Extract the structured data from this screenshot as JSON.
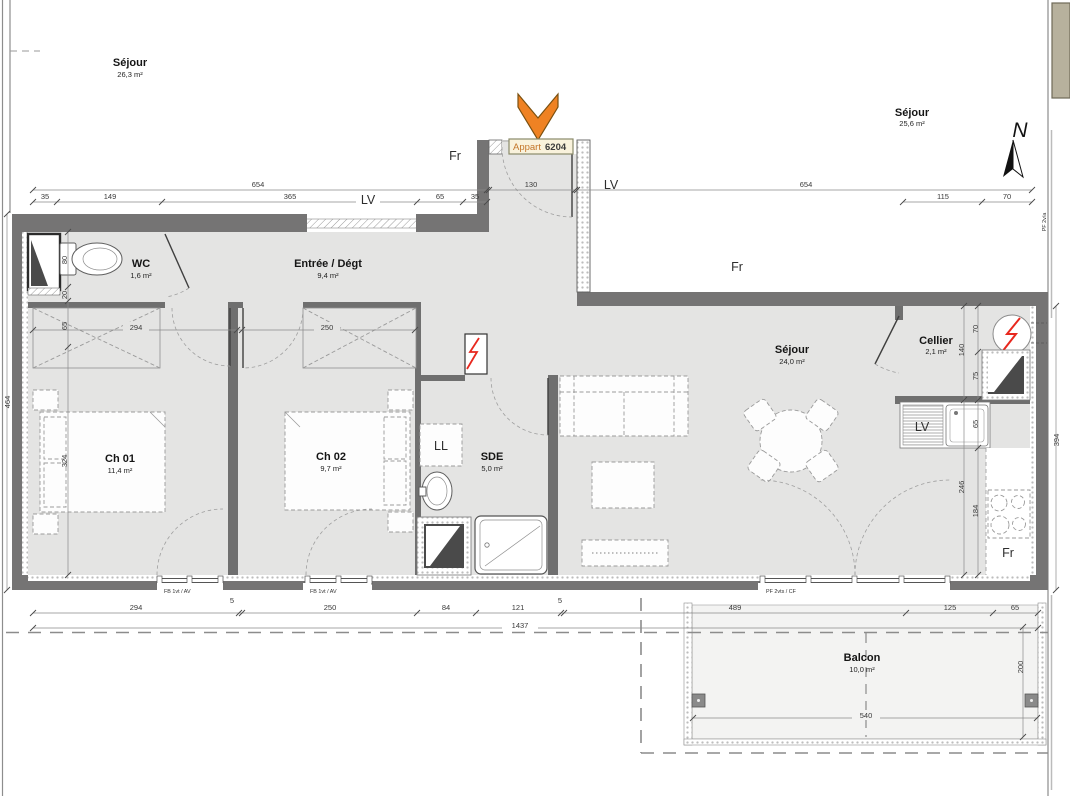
{
  "plan": {
    "apartment": {
      "prefix": "Appart",
      "number": "6204"
    },
    "north_label": "N",
    "rooms": {
      "neighbor_left": {
        "name": "Séjour",
        "area": "26,3 m²"
      },
      "neighbor_right": {
        "name": "Séjour",
        "area": "25,6 m²"
      },
      "wc": {
        "name": "WC",
        "area": "1,6 m²"
      },
      "entree": {
        "name": "Entrée / Dégt",
        "area": "9,4 m²"
      },
      "ch01": {
        "name": "Ch 01",
        "area": "11,4 m²"
      },
      "ch02": {
        "name": "Ch 02",
        "area": "9,7 m²"
      },
      "sde": {
        "name": "SDE",
        "area": "5,0 m²"
      },
      "sejour": {
        "name": "Séjour",
        "area": "24,0 m²"
      },
      "cellier": {
        "name": "Cellier",
        "area": "2,1 m²"
      },
      "balcon": {
        "name": "Balcon",
        "area": "10,0 m²"
      }
    },
    "fixture_labels": {
      "washing_machine": "LL",
      "dishwasher": "LV",
      "fridge": "Fr",
      "fr_top": "Fr",
      "fr_mid": "Fr",
      "lv_top": "LV",
      "lv_mid": "LV"
    },
    "joinery_tags": {
      "window_1": "FB 1vt / AV",
      "window_2": "FB 1vt / AV",
      "french_door": "PF 2vts / CF",
      "side_tag": "PF 2v/a"
    },
    "dims": {
      "top": {
        "total_left": "654",
        "s35a": "35",
        "s149": "149",
        "s365": "365",
        "s65": "65",
        "s35b": "35",
        "entrance": "130",
        "total_right": "654",
        "s115": "115",
        "s70": "70"
      },
      "bottom": {
        "s294": "294",
        "s5a": "5",
        "s250": "250",
        "s84": "84",
        "s121": "121",
        "s5b": "5",
        "s489": "489",
        "s125": "125",
        "s65": "65",
        "total": "1437"
      },
      "left": {
        "total": "464",
        "s80": "80",
        "s20": "20",
        "s65": "65",
        "s324": "324"
      },
      "inner": {
        "ch01_width": "294",
        "ch02_width": "250"
      },
      "right": {
        "s70": "70",
        "s140": "140",
        "s75": "75",
        "s65": "65",
        "s246": "246",
        "s184": "184",
        "total": "394"
      },
      "balcony": {
        "width": "540",
        "depth": "200"
      }
    },
    "colors": {
      "wall": "#757474",
      "floor": "#e4e4e3",
      "arrow_orange": "#ef8223",
      "electric_red": "#e8281e",
      "label_box": "#f9f2dc"
    }
  }
}
